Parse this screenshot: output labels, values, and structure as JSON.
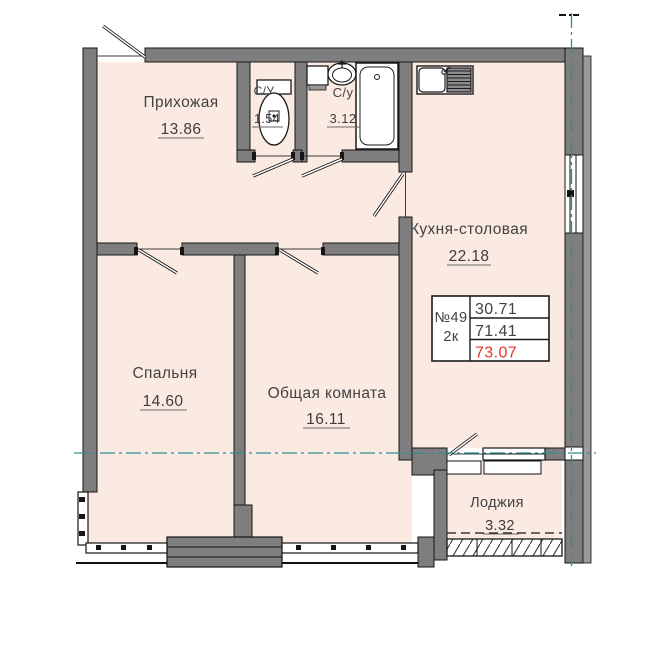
{
  "plan": {
    "title": "Apartment floor plan",
    "rooms": [
      {
        "name": "Прихожая",
        "area": "13.86"
      },
      {
        "name": "С/У",
        "area": "1.54"
      },
      {
        "name": "С/у",
        "area": "3.12"
      },
      {
        "name": "Кухня-столовая",
        "area": "22.18"
      },
      {
        "name": "Спальня",
        "area": "14.60"
      },
      {
        "name": "Общая комната",
        "area": "16.11"
      },
      {
        "name": "Лоджия",
        "area": "3.32"
      }
    ],
    "info_box": {
      "number": "№49",
      "type": "2к",
      "living_area": "30.71",
      "area_no_balcony": "71.41",
      "total_area": "73.07"
    },
    "fixtures": [
      "toilet",
      "washbasin",
      "cabinet",
      "bathtub",
      "kitchen-sink"
    ],
    "colors": {
      "wall": "#7e7e7e",
      "wall_outline": "#151515",
      "floor": "#faeae2",
      "axis_teal": "#2e8f92",
      "total_red": "#e5322b",
      "text": "#424242"
    }
  }
}
